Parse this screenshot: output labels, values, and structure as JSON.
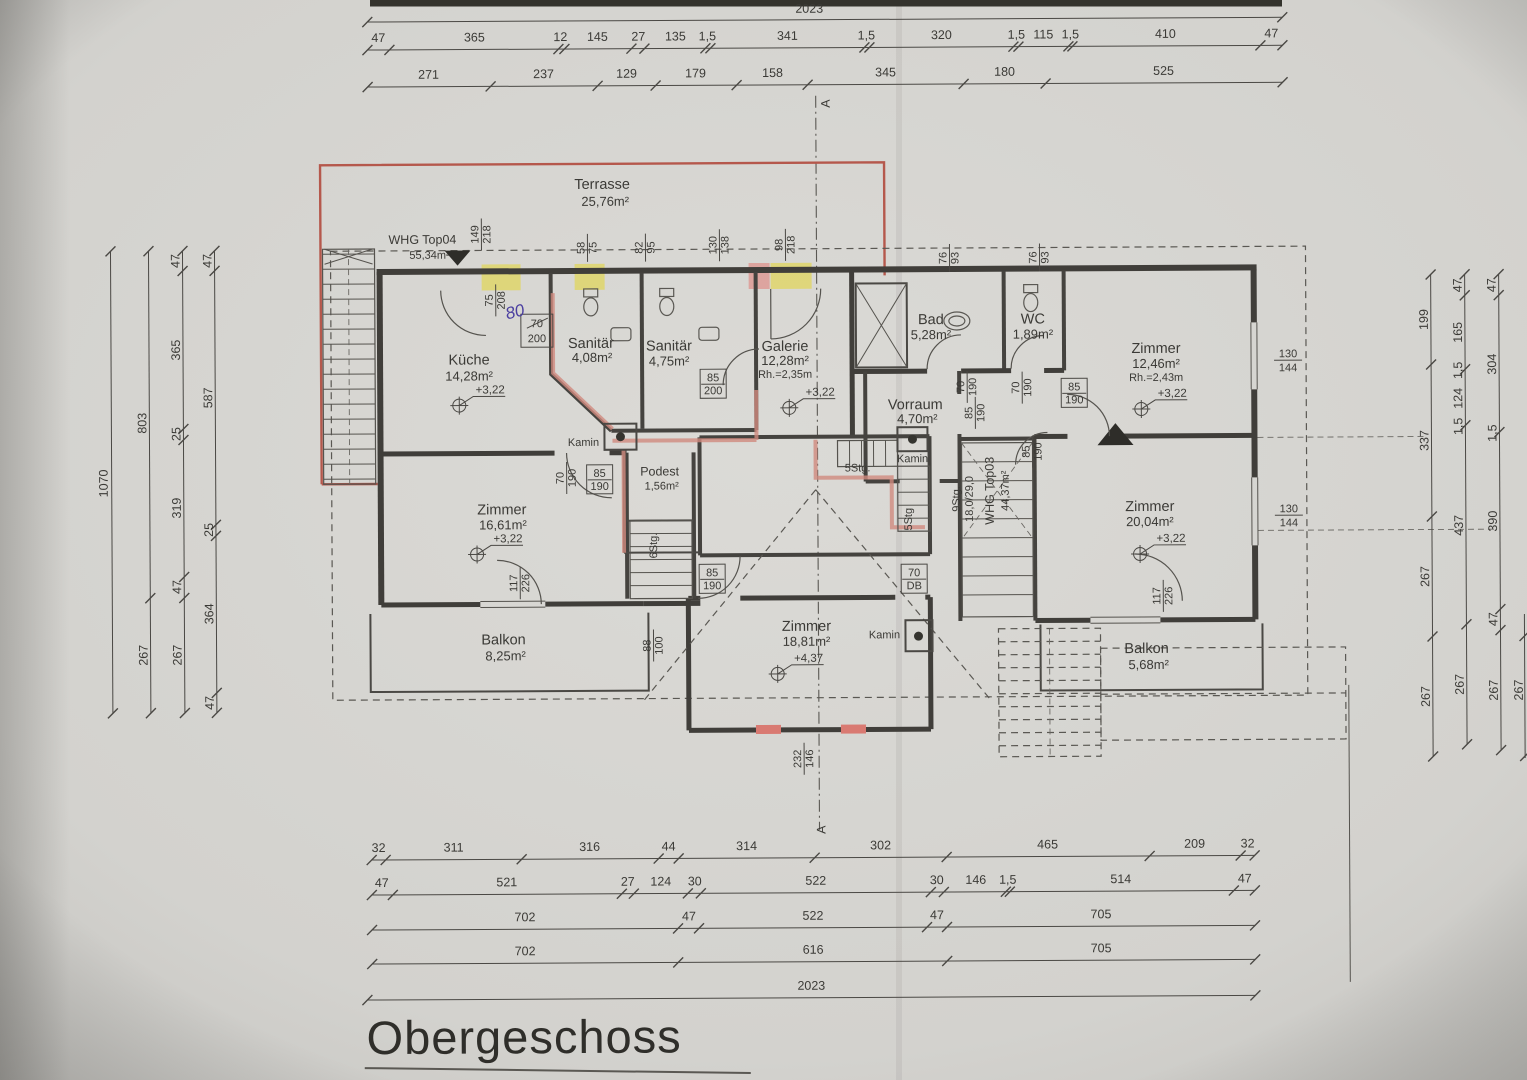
{
  "title": "Obergeschoss",
  "section": {
    "label": "A"
  },
  "totals": {
    "top": "2023",
    "bottom": "2023"
  },
  "apartments": {
    "top04": {
      "name": "WHG Top04",
      "area": "55,34m²"
    },
    "top03": {
      "name": "WHG Top03",
      "area": "44,37m²"
    }
  },
  "rooms": {
    "terrasse": {
      "name": "Terrasse",
      "area": "25,76m²"
    },
    "kueche": {
      "name": "Küche",
      "area": "14,28m²",
      "level": "+3,22"
    },
    "san1": {
      "name": "Sanitär",
      "area": "4,08m²"
    },
    "san2": {
      "name": "Sanitär",
      "area": "4,75m²"
    },
    "galerie": {
      "name": "Galerie",
      "area": "12,28m²",
      "rh": "Rh.=2,35m",
      "level": "+3,22"
    },
    "bad": {
      "name": "Bad",
      "area": "5,28m²"
    },
    "wc": {
      "name": "WC",
      "area": "1,89m²"
    },
    "zimmer1": {
      "name": "Zimmer",
      "area": "12,46m²",
      "rh": "Rh.=2,43m",
      "level": "+3,22"
    },
    "vorraum": {
      "name": "Vorraum",
      "area": "4,70m²"
    },
    "podest": {
      "name": "Podest",
      "area": "1,56m²"
    },
    "zimmer2": {
      "name": "Zimmer",
      "area": "16,61m²",
      "level": "+3,22"
    },
    "zimmer3": {
      "name": "Zimmer",
      "area": "18,81m²",
      "level": "+4,37"
    },
    "zimmer4": {
      "name": "Zimmer",
      "area": "20,04m²",
      "level": "+3,22"
    },
    "balkon1": {
      "name": "Balkon",
      "area": "8,25m²"
    },
    "balkon2": {
      "name": "Balkon",
      "area": "5,68m²"
    },
    "kamin": "Kamin"
  },
  "stairs": {
    "s6": "6Stg.",
    "s5a": "5Stg.",
    "s5b": "5Stg",
    "s9": "9Stg.",
    "s9dim": "18,0/29,0"
  },
  "notes": {
    "hand": "80",
    "crossed": "70",
    "below": "200"
  },
  "dims": {
    "top1": [
      "47",
      "365",
      "12",
      "145",
      "27",
      "135",
      "1,5",
      "341",
      "1,5",
      "320",
      "1,5",
      "115",
      "1,5",
      "410",
      "47"
    ],
    "top2": [
      "271",
      "237",
      "129",
      "179",
      "158",
      "345",
      "180",
      "525"
    ],
    "bottom1": [
      "32",
      "311",
      "316",
      "44",
      "314",
      "302",
      "465",
      "209",
      "32"
    ],
    "bottom2": [
      "47",
      "521",
      "27",
      "124",
      "30",
      "522",
      "30",
      "146",
      "1,5",
      "514",
      "47"
    ],
    "bottom3": [
      "702",
      "47",
      "522",
      "47",
      "705"
    ],
    "bottom4": [
      "702",
      "616",
      "705"
    ],
    "left1": [
      "1070"
    ],
    "left2": [
      "803",
      "267"
    ],
    "left3": [
      "47",
      "365",
      "25",
      "319",
      "47",
      "267"
    ],
    "left4": [
      "47",
      "587",
      "25",
      "364",
      "47"
    ],
    "right1": [
      "199",
      "337",
      "267",
      "267"
    ],
    "right2": [
      "47",
      "165",
      "1,5",
      "124",
      "1,5",
      "437",
      "267"
    ],
    "right3": [
      "47",
      "304",
      "1,5",
      "390",
      "47",
      "267"
    ],
    "right4": [
      "267"
    ],
    "openings": [
      {
        "a": "149",
        "b": "218"
      },
      {
        "a": "58",
        "b": "75"
      },
      {
        "a": "82",
        "b": "95"
      },
      {
        "a": "130",
        "b": "138"
      },
      {
        "a": "98",
        "b": "218"
      },
      {
        "a": "75",
        "b": "208"
      },
      {
        "a": "76",
        "b": "93"
      },
      {
        "a": "76",
        "b": "93"
      },
      {
        "a": "85",
        "b": "200"
      },
      {
        "a": "85",
        "b": "190"
      },
      {
        "a": "70",
        "b": "190"
      },
      {
        "a": "70",
        "b": "190"
      },
      {
        "a": "70",
        "b": "190"
      },
      {
        "a": "85",
        "b": "190"
      },
      {
        "a": "85",
        "b": "190"
      },
      {
        "a": "85",
        "b": "190"
      },
      {
        "a": "85",
        "b": "190"
      },
      {
        "a": "70",
        "b": "DB"
      },
      {
        "a": "117",
        "b": "226"
      },
      {
        "a": "117",
        "b": "226"
      },
      {
        "a": "130",
        "b": "144"
      },
      {
        "a": "130",
        "b": "144"
      },
      {
        "a": "88",
        "b": "100"
      },
      {
        "a": "232",
        "b": "146"
      }
    ]
  }
}
